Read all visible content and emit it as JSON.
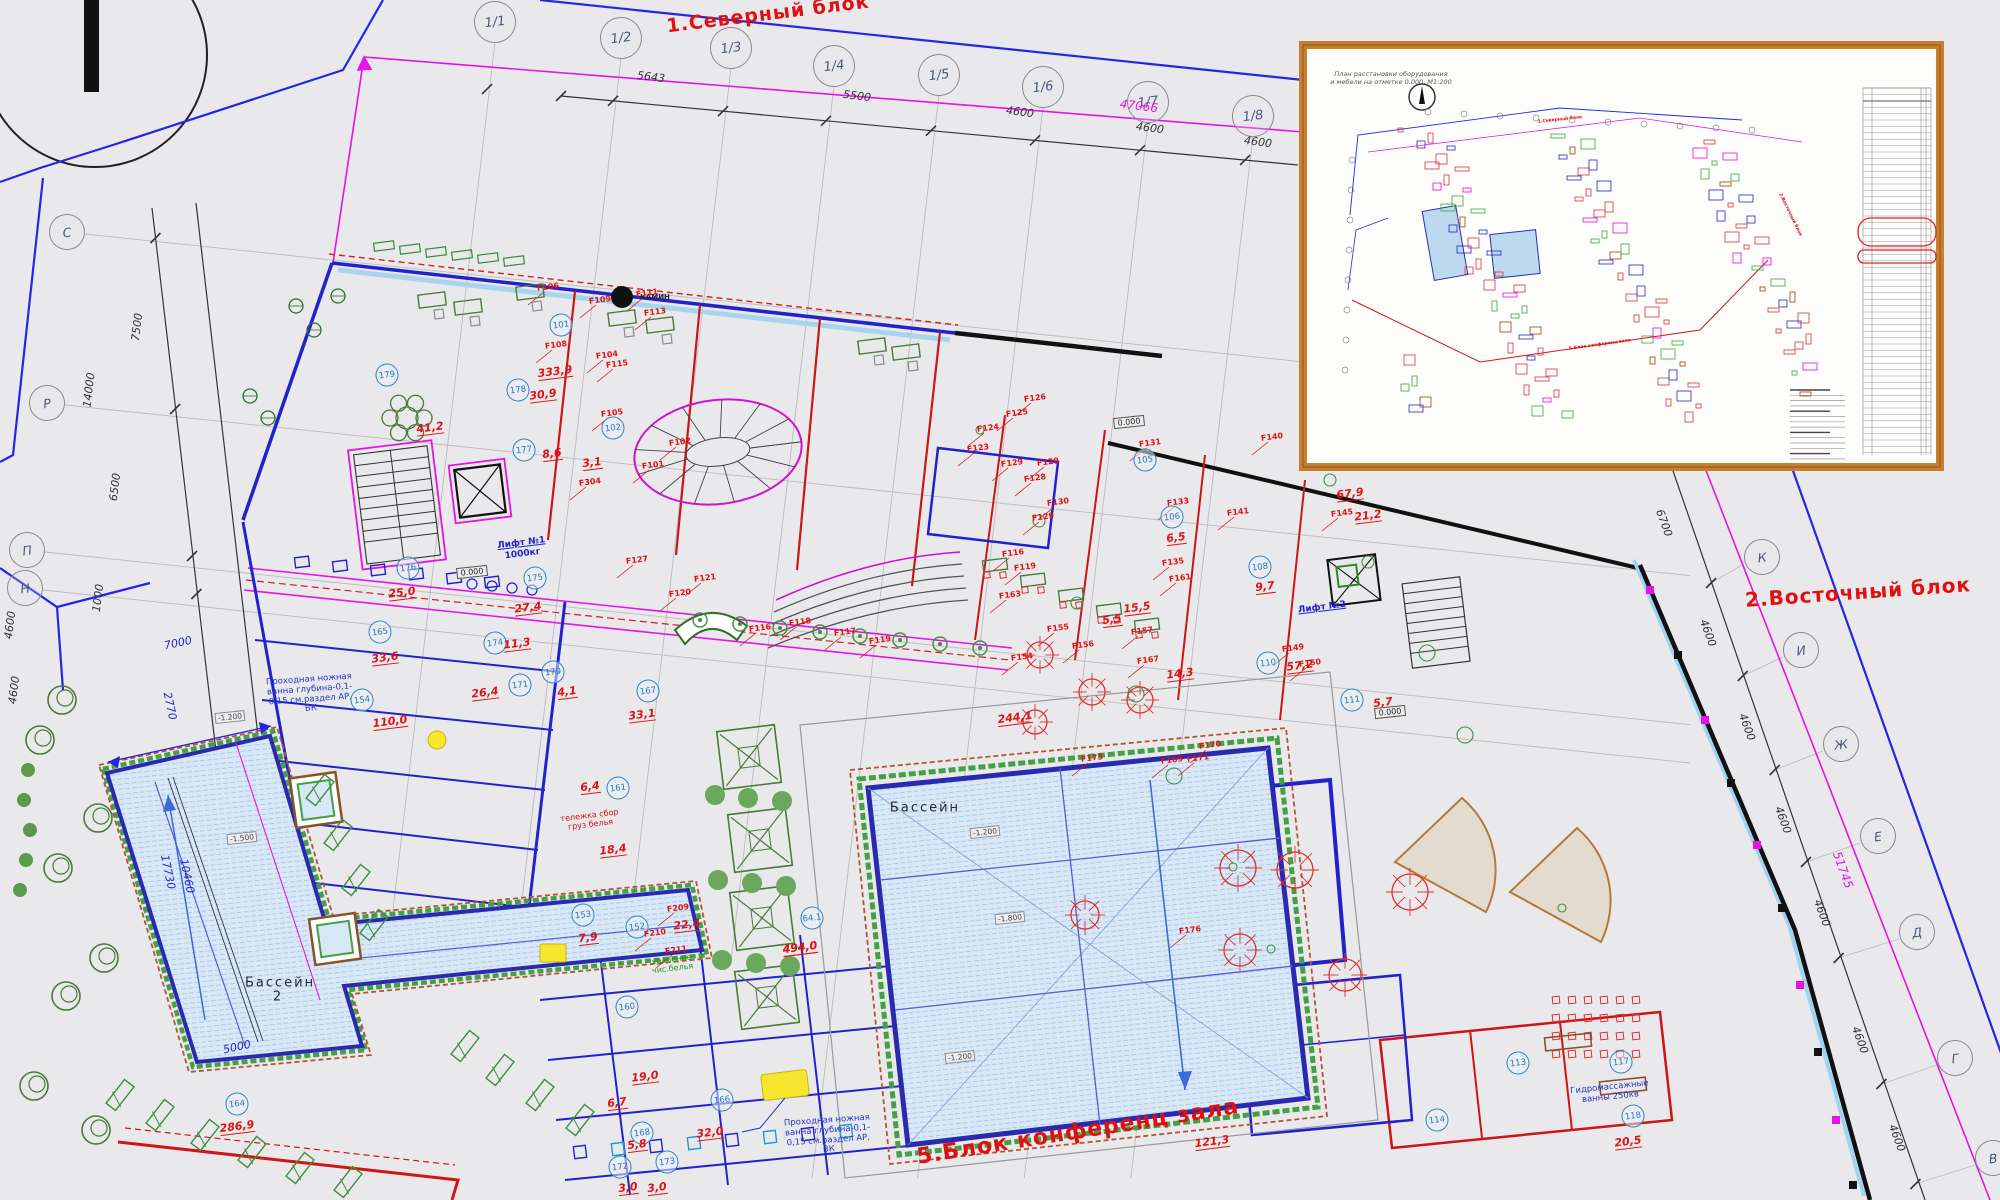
{
  "titles": {
    "north_block": "1.Северный блок",
    "east_block": "2.Восточный блок",
    "conference_block": "5.Блок конференц зала"
  },
  "inset": {
    "title_line1": "План расстановки оборудования",
    "title_line2": "и мебели на отметке 0.000, М1:200",
    "mini_labels": [
      {
        "t": "1.Северный блок",
        "x": 1560,
        "y": 120,
        "r": -6
      },
      {
        "t": "2.Восточный блок",
        "x": 1790,
        "y": 215,
        "r": 64
      },
      {
        "t": "5.Блок конференц зала",
        "x": 1600,
        "y": 345,
        "r": -8
      }
    ]
  },
  "pools": {
    "main": {
      "label": "Бассейн",
      "area": "494,0",
      "room": "64.1"
    },
    "secondary": {
      "label": "Бассейн 2",
      "area": "286,9",
      "room": "164"
    }
  },
  "lifts": {
    "lift1_line1": "Лифт №1",
    "lift1_line2": "1000кг",
    "lift2": "Лифт №2"
  },
  "notes": {
    "foot_bath": "Проходная ножная ванна глубина-0,1-0,15 см.раздел АР, ВК",
    "laundry_cart": "тележка сбор груз белья",
    "linen_storage": "хранение чис.белья",
    "hydro": "Гидромассажные ванны 250кв",
    "fireplace": "КАМИН"
  },
  "grid_axes": {
    "top": [
      {
        "label": "1/1",
        "x": 495,
        "y": 22
      },
      {
        "label": "1/2",
        "x": 621,
        "y": 38
      },
      {
        "label": "1/3",
        "x": 731,
        "y": 48
      },
      {
        "label": "1/4",
        "x": 834,
        "y": 66
      },
      {
        "label": "1/5",
        "x": 939,
        "y": 75
      },
      {
        "label": "1/6",
        "x": 1043,
        "y": 87
      },
      {
        "label": "1/7",
        "x": 1148,
        "y": 102
      },
      {
        "label": "1/8",
        "x": 1253,
        "y": 116
      }
    ],
    "left": [
      {
        "label": "С",
        "x": 67,
        "y": 232
      },
      {
        "label": "Р",
        "x": 47,
        "y": 403
      },
      {
        "label": "П",
        "x": 27,
        "y": 550
      },
      {
        "label": "Н",
        "x": 25,
        "y": 588
      }
    ],
    "right": [
      {
        "label": "К",
        "x": 1762,
        "y": 557
      },
      {
        "label": "И",
        "x": 1801,
        "y": 650
      },
      {
        "label": "Ж",
        "x": 1841,
        "y": 744
      },
      {
        "label": "Е",
        "x": 1878,
        "y": 836
      },
      {
        "label": "Д",
        "x": 1917,
        "y": 932
      },
      {
        "label": "Г",
        "x": 1955,
        "y": 1058
      },
      {
        "label": "В",
        "x": 1993,
        "y": 1158
      }
    ]
  },
  "dim_labels": [
    {
      "t": "5643",
      "x": 651,
      "y": 77,
      "r": 7,
      "c": "k"
    },
    {
      "t": "5500",
      "x": 857,
      "y": 96,
      "r": 7,
      "c": "k"
    },
    {
      "t": "4600",
      "x": 1020,
      "y": 112,
      "r": 7,
      "c": "k"
    },
    {
      "t": "4600",
      "x": 1150,
      "y": 128,
      "r": 7,
      "c": "k"
    },
    {
      "t": "4600",
      "x": 1258,
      "y": 142,
      "r": 7,
      "c": "k"
    },
    {
      "t": "47066",
      "x": 1139,
      "y": 106,
      "r": 7,
      "c": "m"
    },
    {
      "t": "7500",
      "x": 137,
      "y": 327,
      "r": -83,
      "c": "k"
    },
    {
      "t": "14000",
      "x": 89,
      "y": 390,
      "r": -83,
      "c": "k"
    },
    {
      "t": "6500",
      "x": 115,
      "y": 487,
      "r": -83,
      "c": "k"
    },
    {
      "t": "1000",
      "x": 98,
      "y": 598,
      "r": -83,
      "c": "k"
    },
    {
      "t": "4600",
      "x": 10,
      "y": 625,
      "r": -83,
      "c": "k"
    },
    {
      "t": "4600",
      "x": 14,
      "y": 690,
      "r": -83,
      "c": "k"
    },
    {
      "t": "6700",
      "x": 1664,
      "y": 523,
      "r": 70,
      "c": "k"
    },
    {
      "t": "4600",
      "x": 1708,
      "y": 633,
      "r": 70,
      "c": "k"
    },
    {
      "t": "4600",
      "x": 1747,
      "y": 727,
      "r": 70,
      "c": "k"
    },
    {
      "t": "4600",
      "x": 1783,
      "y": 820,
      "r": 70,
      "c": "k"
    },
    {
      "t": "4600",
      "x": 1822,
      "y": 913,
      "r": 70,
      "c": "k"
    },
    {
      "t": "4600",
      "x": 1860,
      "y": 1040,
      "r": 70,
      "c": "k"
    },
    {
      "t": "4600",
      "x": 1897,
      "y": 1138,
      "r": 70,
      "c": "k"
    },
    {
      "t": "51745",
      "x": 1843,
      "y": 870,
      "r": 70,
      "c": "m"
    },
    {
      "t": "7000",
      "x": 178,
      "y": 643,
      "r": -12,
      "c": "b"
    },
    {
      "t": "2770",
      "x": 170,
      "y": 706,
      "r": 78,
      "c": "b"
    },
    {
      "t": "17730",
      "x": 168,
      "y": 872,
      "r": 78,
      "c": "b"
    },
    {
      "t": "10460",
      "x": 187,
      "y": 876,
      "r": 78,
      "c": "b"
    },
    {
      "t": "5000",
      "x": 237,
      "y": 1047,
      "r": -12,
      "c": "b"
    }
  ],
  "rooms": [
    {
      "n": "179",
      "x": 387,
      "y": 375
    },
    {
      "n": "178",
      "x": 518,
      "y": 390
    },
    {
      "n": "177",
      "x": 524,
      "y": 450
    },
    {
      "n": "176",
      "x": 408,
      "y": 568
    },
    {
      "n": "175",
      "x": 535,
      "y": 578
    },
    {
      "n": "174",
      "x": 495,
      "y": 643
    },
    {
      "n": "171",
      "x": 520,
      "y": 685
    },
    {
      "n": "170",
      "x": 553,
      "y": 672
    },
    {
      "n": "167",
      "x": 648,
      "y": 691
    },
    {
      "n": "165",
      "x": 380,
      "y": 632
    },
    {
      "n": "154",
      "x": 362,
      "y": 700
    },
    {
      "n": "161",
      "x": 618,
      "y": 788
    },
    {
      "n": "153",
      "x": 583,
      "y": 915
    },
    {
      "n": "152",
      "x": 637,
      "y": 927
    },
    {
      "n": "160",
      "x": 627,
      "y": 1007
    },
    {
      "n": "166",
      "x": 722,
      "y": 1100
    },
    {
      "n": "168",
      "x": 642,
      "y": 1133
    },
    {
      "n": "173",
      "x": 667,
      "y": 1162
    },
    {
      "n": "172",
      "x": 620,
      "y": 1167
    },
    {
      "n": "164",
      "x": 237,
      "y": 1104
    },
    {
      "n": "64.1",
      "x": 812,
      "y": 918
    },
    {
      "n": "101",
      "x": 561,
      "y": 325
    },
    {
      "n": "102",
      "x": 613,
      "y": 428
    },
    {
      "n": "105",
      "x": 1145,
      "y": 460
    },
    {
      "n": "106",
      "x": 1172,
      "y": 517
    },
    {
      "n": "108",
      "x": 1260,
      "y": 567
    },
    {
      "n": "110",
      "x": 1268,
      "y": 663
    },
    {
      "n": "111",
      "x": 1352,
      "y": 700
    },
    {
      "n": "113",
      "x": 1518,
      "y": 1063
    },
    {
      "n": "114",
      "x": 1437,
      "y": 1120
    },
    {
      "n": "117",
      "x": 1621,
      "y": 1062
    },
    {
      "n": "118",
      "x": 1633,
      "y": 1116
    }
  ],
  "areas": [
    {
      "v": "333,9",
      "x": 555,
      "y": 372
    },
    {
      "v": "41,2",
      "x": 430,
      "y": 428
    },
    {
      "v": "30,9",
      "x": 543,
      "y": 395
    },
    {
      "v": "8,6",
      "x": 552,
      "y": 454
    },
    {
      "v": "3,1",
      "x": 592,
      "y": 463
    },
    {
      "v": "25,0",
      "x": 402,
      "y": 593
    },
    {
      "v": "27,4",
      "x": 528,
      "y": 608
    },
    {
      "v": "11,3",
      "x": 517,
      "y": 644
    },
    {
      "v": "26,4",
      "x": 485,
      "y": 693
    },
    {
      "v": "4,1",
      "x": 567,
      "y": 692
    },
    {
      "v": "33,1",
      "x": 642,
      "y": 715
    },
    {
      "v": "33,6",
      "x": 385,
      "y": 658
    },
    {
      "v": "110,0",
      "x": 390,
      "y": 722
    },
    {
      "v": "6,4",
      "x": 590,
      "y": 787
    },
    {
      "v": "18,4",
      "x": 613,
      "y": 850
    },
    {
      "v": "7,9",
      "x": 588,
      "y": 938
    },
    {
      "v": "22,4",
      "x": 687,
      "y": 925
    },
    {
      "v": "19,0",
      "x": 645,
      "y": 1077
    },
    {
      "v": "6,7",
      "x": 617,
      "y": 1103
    },
    {
      "v": "32,0",
      "x": 710,
      "y": 1133
    },
    {
      "v": "5,8",
      "x": 637,
      "y": 1145
    },
    {
      "v": "3,0",
      "x": 628,
      "y": 1188
    },
    {
      "v": "3,0",
      "x": 657,
      "y": 1188
    },
    {
      "v": "494,0",
      "x": 800,
      "y": 948
    },
    {
      "v": "286,9",
      "x": 237,
      "y": 1127
    },
    {
      "v": "67,9",
      "x": 1350,
      "y": 494
    },
    {
      "v": "21,2",
      "x": 1368,
      "y": 516
    },
    {
      "v": "57,2",
      "x": 1300,
      "y": 666
    },
    {
      "v": "5,7",
      "x": 1383,
      "y": 703
    },
    {
      "v": "14,3",
      "x": 1180,
      "y": 674
    },
    {
      "v": "5,5",
      "x": 1112,
      "y": 620
    },
    {
      "v": "6,5",
      "x": 1176,
      "y": 538
    },
    {
      "v": "9,7",
      "x": 1265,
      "y": 587
    },
    {
      "v": "15,5",
      "x": 1137,
      "y": 608
    },
    {
      "v": "244,1",
      "x": 1015,
      "y": 718
    },
    {
      "v": "121,3",
      "x": 1212,
      "y": 1142
    },
    {
      "v": "20,5",
      "x": 1628,
      "y": 1142
    }
  ],
  "f_labels": [
    {
      "c": "F101",
      "x": 653,
      "y": 465
    },
    {
      "c": "F102",
      "x": 680,
      "y": 442
    },
    {
      "c": "F104",
      "x": 607,
      "y": 355
    },
    {
      "c": "F105",
      "x": 612,
      "y": 413
    },
    {
      "c": "F106",
      "x": 548,
      "y": 287
    },
    {
      "c": "F108",
      "x": 556,
      "y": 345
    },
    {
      "c": "F109",
      "x": 600,
      "y": 300
    },
    {
      "c": "F111",
      "x": 647,
      "y": 293
    },
    {
      "c": "F113",
      "x": 655,
      "y": 312
    },
    {
      "c": "F115",
      "x": 617,
      "y": 364
    },
    {
      "c": "F116",
      "x": 760,
      "y": 628
    },
    {
      "c": "F117",
      "x": 845,
      "y": 632
    },
    {
      "c": "F118",
      "x": 800,
      "y": 622
    },
    {
      "c": "F119",
      "x": 880,
      "y": 640
    },
    {
      "c": "F116",
      "x": 1013,
      "y": 553
    },
    {
      "c": "F119",
      "x": 1025,
      "y": 567
    },
    {
      "c": "F120",
      "x": 680,
      "y": 593
    },
    {
      "c": "F121",
      "x": 705,
      "y": 578
    },
    {
      "c": "F127",
      "x": 637,
      "y": 560
    },
    {
      "c": "F123",
      "x": 978,
      "y": 448
    },
    {
      "c": "F124",
      "x": 988,
      "y": 428
    },
    {
      "c": "F125",
      "x": 1017,
      "y": 413
    },
    {
      "c": "F126",
      "x": 1035,
      "y": 398
    },
    {
      "c": "F128",
      "x": 1035,
      "y": 478
    },
    {
      "c": "F129",
      "x": 1012,
      "y": 463
    },
    {
      "c": "F129",
      "x": 1048,
      "y": 462
    },
    {
      "c": "F129",
      "x": 1043,
      "y": 517
    },
    {
      "c": "F130",
      "x": 1058,
      "y": 502
    },
    {
      "c": "F131",
      "x": 1150,
      "y": 443
    },
    {
      "c": "F133",
      "x": 1178,
      "y": 502
    },
    {
      "c": "F135",
      "x": 1173,
      "y": 562
    },
    {
      "c": "F140",
      "x": 1272,
      "y": 437
    },
    {
      "c": "F141",
      "x": 1238,
      "y": 512
    },
    {
      "c": "F145",
      "x": 1342,
      "y": 513
    },
    {
      "c": "F149",
      "x": 1293,
      "y": 648
    },
    {
      "c": "F150",
      "x": 1310,
      "y": 663
    },
    {
      "c": "F154",
      "x": 1022,
      "y": 657
    },
    {
      "c": "F155",
      "x": 1058,
      "y": 628
    },
    {
      "c": "F156",
      "x": 1083,
      "y": 645
    },
    {
      "c": "F157",
      "x": 1142,
      "y": 631
    },
    {
      "c": "F161",
      "x": 1180,
      "y": 578
    },
    {
      "c": "F163",
      "x": 1010,
      "y": 595
    },
    {
      "c": "F167",
      "x": 1148,
      "y": 660
    },
    {
      "c": "F169",
      "x": 1172,
      "y": 760
    },
    {
      "c": "F170",
      "x": 1210,
      "y": 745
    },
    {
      "c": "F171",
      "x": 1198,
      "y": 758
    },
    {
      "c": "F173",
      "x": 1092,
      "y": 758
    },
    {
      "c": "F176",
      "x": 1190,
      "y": 930
    },
    {
      "c": "F209",
      "x": 678,
      "y": 908
    },
    {
      "c": "F210",
      "x": 655,
      "y": 933
    },
    {
      "c": "F211",
      "x": 676,
      "y": 950
    },
    {
      "c": "F304",
      "x": 590,
      "y": 482
    }
  ],
  "depth_boxes": [
    {
      "t": "-1.200",
      "x": 985,
      "y": 832
    },
    {
      "t": "-1.800",
      "x": 1010,
      "y": 918
    },
    {
      "t": "-1.200",
      "x": 960,
      "y": 1057
    },
    {
      "t": "-1.200",
      "x": 230,
      "y": 717
    },
    {
      "t": "-1.500",
      "x": 242,
      "y": 838
    }
  ],
  "level_boxes": [
    {
      "t": "0.000",
      "x": 472,
      "y": 572
    },
    {
      "t": "0.000",
      "x": 1129,
      "y": 422
    },
    {
      "t": "0.000",
      "x": 1390,
      "y": 712
    }
  ]
}
